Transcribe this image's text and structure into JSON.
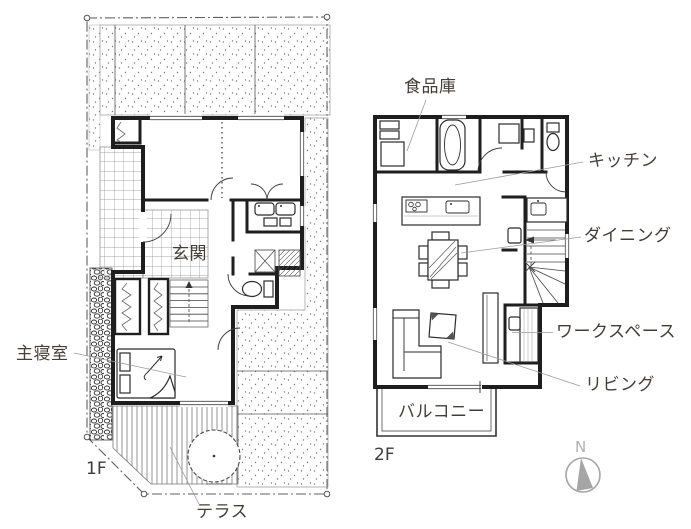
{
  "floor1": {
    "floor_label": "1F",
    "rooms": {
      "entrance": "玄関",
      "master_bedroom": "主寝室",
      "terrace": "テラス"
    }
  },
  "floor2": {
    "floor_label": "2F",
    "rooms": {
      "pantry": "食品庫",
      "kitchen": "キッチン",
      "dining": "ダイニング",
      "workspace": "ワークスペース",
      "living": "リビング",
      "balcony": "バルコニー"
    }
  },
  "compass": {
    "north_label": "N"
  },
  "colors": {
    "ink": "#1e1e1e",
    "label_text": "#463d35",
    "leader_line": "#9b9b9b",
    "compass_gray": "#a5a5a5"
  }
}
